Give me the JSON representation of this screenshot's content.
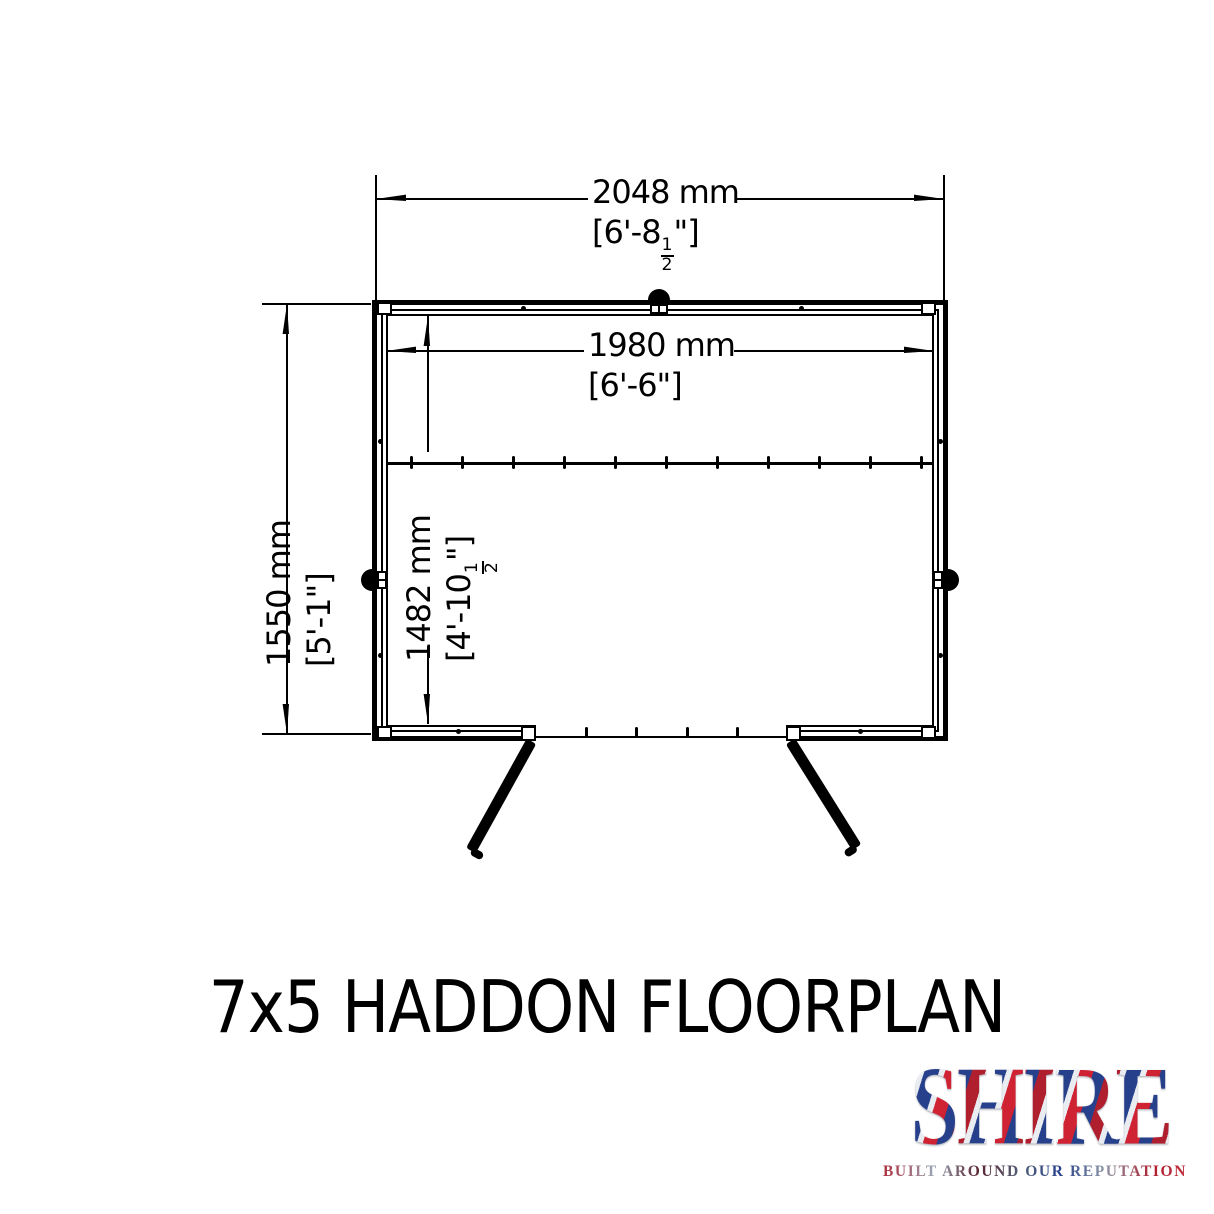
{
  "title": "7x5 HADDON FLOORPLAN",
  "plan": {
    "overall_width": {
      "mm": "2048 mm",
      "imperial_prefix": "[6'-8",
      "fraction_numerator": "1",
      "fraction_denominator": "2",
      "imperial_suffix": "\"]"
    },
    "internal_width": {
      "mm": "1980 mm",
      "imperial": "[6'-6\"]"
    },
    "overall_depth": {
      "mm": "1550 mm",
      "imperial": "[5'-1\"]"
    },
    "internal_depth": {
      "mm": "1482 mm",
      "imperial_prefix": "[4'-10",
      "fraction_numerator": "1",
      "fraction_denominator": "2",
      "imperial_suffix": "\"]"
    }
  },
  "logo": {
    "name": "SHIRE",
    "tagline": "BUILT AROUND OUR REPUTATION"
  },
  "colors": {
    "ink": "#000000",
    "logo_red": "#b01f2e",
    "logo_blue": "#27408b",
    "logo_silver": "#e9edf2"
  }
}
